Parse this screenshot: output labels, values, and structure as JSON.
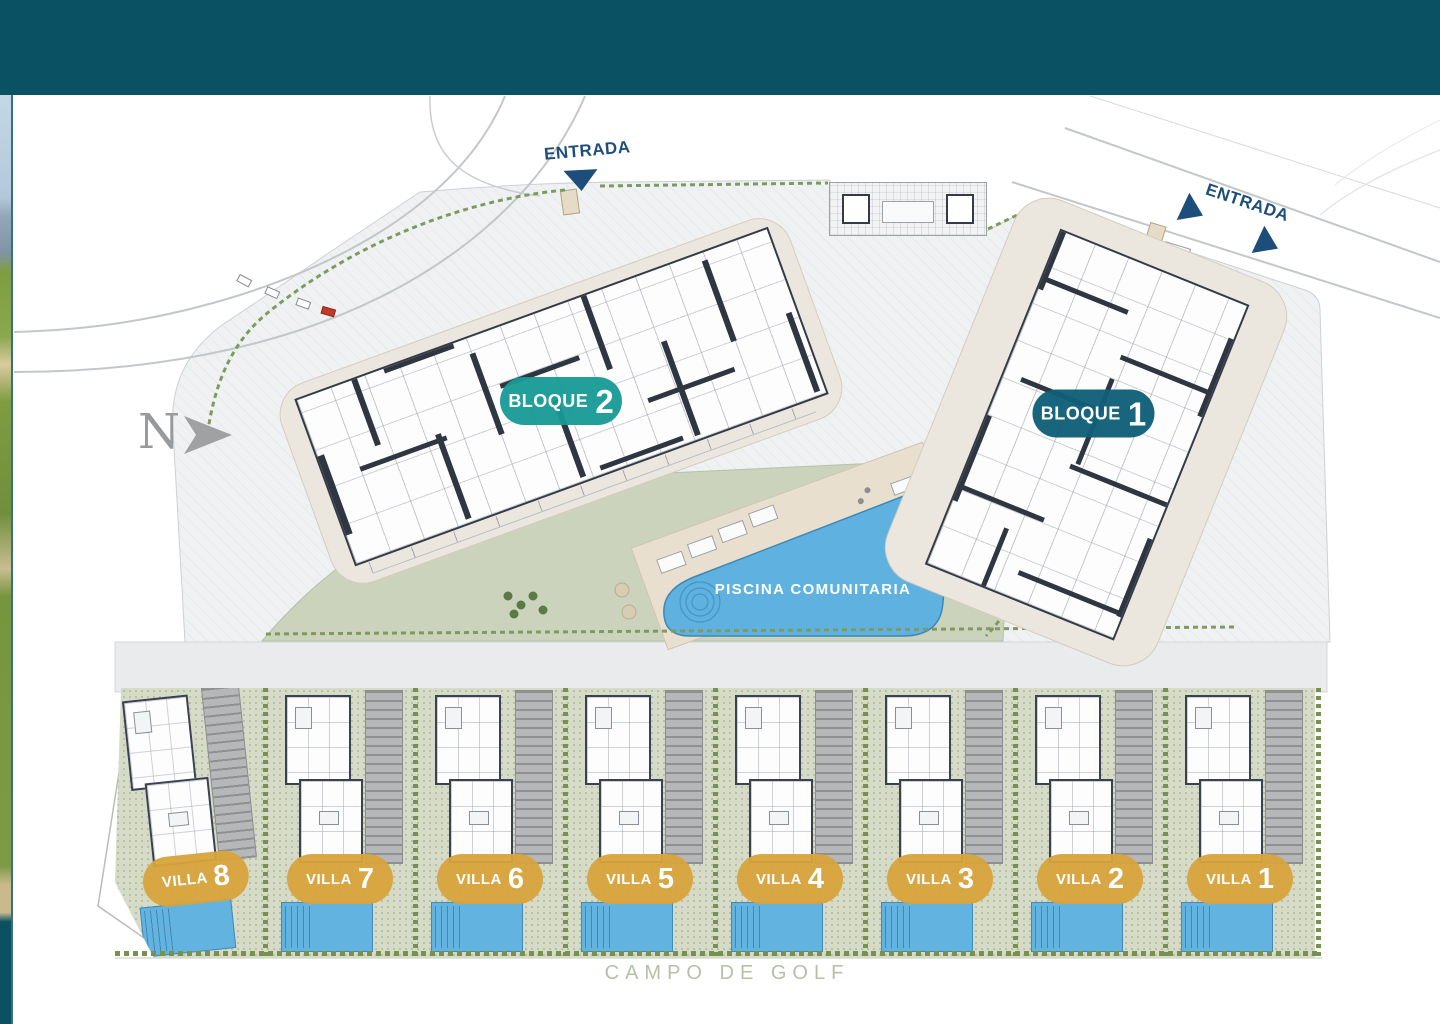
{
  "compass": {
    "label": "N"
  },
  "entrance_top": {
    "label": "ENTRADA"
  },
  "entrance_right": {
    "label": "ENTRADA"
  },
  "blocks": [
    {
      "label": "BLOQUE",
      "number": "2",
      "pill_color": "#179a96"
    },
    {
      "label": "BLOQUE",
      "number": "1",
      "pill_color": "#0f5f78"
    }
  ],
  "pool": {
    "label": "PISCINA COMUNITARIA",
    "water_color": "#5fb2e0"
  },
  "villas": [
    {
      "label": "VILLA",
      "number": "8"
    },
    {
      "label": "VILLA",
      "number": "7"
    },
    {
      "label": "VILLA",
      "number": "6"
    },
    {
      "label": "VILLA",
      "number": "5"
    },
    {
      "label": "VILLA",
      "number": "4"
    },
    {
      "label": "VILLA",
      "number": "3"
    },
    {
      "label": "VILLA",
      "number": "2"
    },
    {
      "label": "VILLA",
      "number": "1"
    }
  ],
  "footer": {
    "label": "CAMPO DE GOLF"
  },
  "colors": {
    "banner_teal": "#0a5163",
    "entrance_blue": "#1d4e7b",
    "villa_pill_gold": "#d9a33c",
    "lawn_green": "#ccd3bd",
    "paving_gray": "#eff1f2",
    "plot_beige": "#ece7de",
    "pool_blue": "#5fb2e0"
  }
}
